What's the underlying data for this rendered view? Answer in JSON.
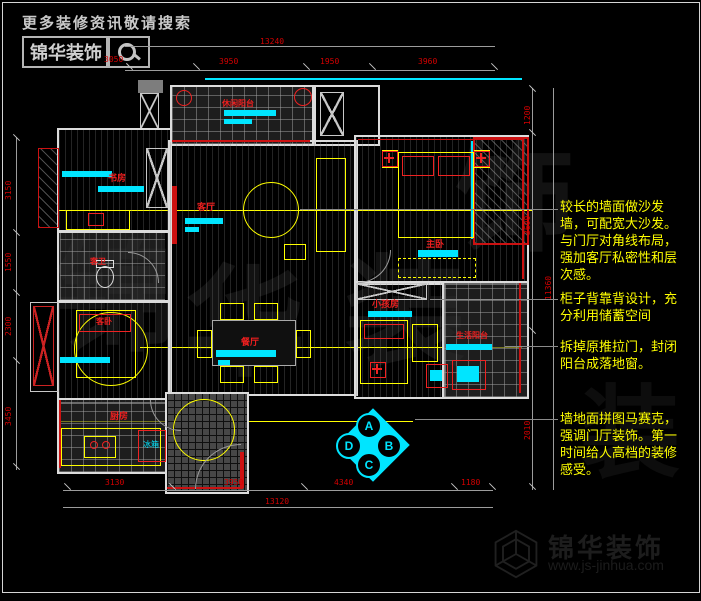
{
  "header": {
    "tagline": "更多装修资讯敬请搜索",
    "brand": "锦华装饰"
  },
  "footer": {
    "brand": "锦华装饰",
    "url": "www.js-jinhua.com"
  },
  "watermark": {
    "chars": [
      "锦",
      "华",
      "装",
      "饰"
    ]
  },
  "rooms": {
    "balcony_top": "休闲阳台",
    "study": "书房",
    "living": "客厅",
    "dining": "餐厅",
    "master": "主卧",
    "kids": "小孩房",
    "service_balcony": "生活阳台",
    "kitchen": "厨房",
    "fridge": "冰箱",
    "guest_bath": "客卫",
    "guest_bed": "客卧"
  },
  "dims": {
    "top_total": "13240",
    "top_segments": [
      "3050",
      "3950",
      "1950",
      "3960"
    ],
    "bottom_segments": [
      "3130",
      "3950",
      "4340",
      "1180"
    ],
    "bottom_total": "13120",
    "left_segments": [
      "3150",
      "1550",
      "2300",
      "3450"
    ],
    "right_segments": [
      "1200",
      "3600",
      "2010"
    ],
    "right_total": "11360"
  },
  "annotations": [
    {
      "text": "较长的墙面做沙发墙，可配宽大沙发。与门厅对角线布局，强加客厅私密性和层次感。"
    },
    {
      "text": "柜子背靠背设计，充分利用储蓄空间"
    },
    {
      "text": "拆掉原推拉门，封闭阳台成落地窗。"
    },
    {
      "text": "墙地面拼图马赛克，强调门厅装饰。第一时间给人高档的装修感受。"
    }
  ],
  "compass": {
    "a": "A",
    "b": "B",
    "c": "C",
    "d": "D"
  },
  "colors": {
    "wall": "#dcdcdc",
    "red": "#cc1111",
    "cyan": "#00e5ff",
    "yellow": "#ffff00",
    "dimred": "#d40000",
    "gray": "#9a9a9a"
  }
}
